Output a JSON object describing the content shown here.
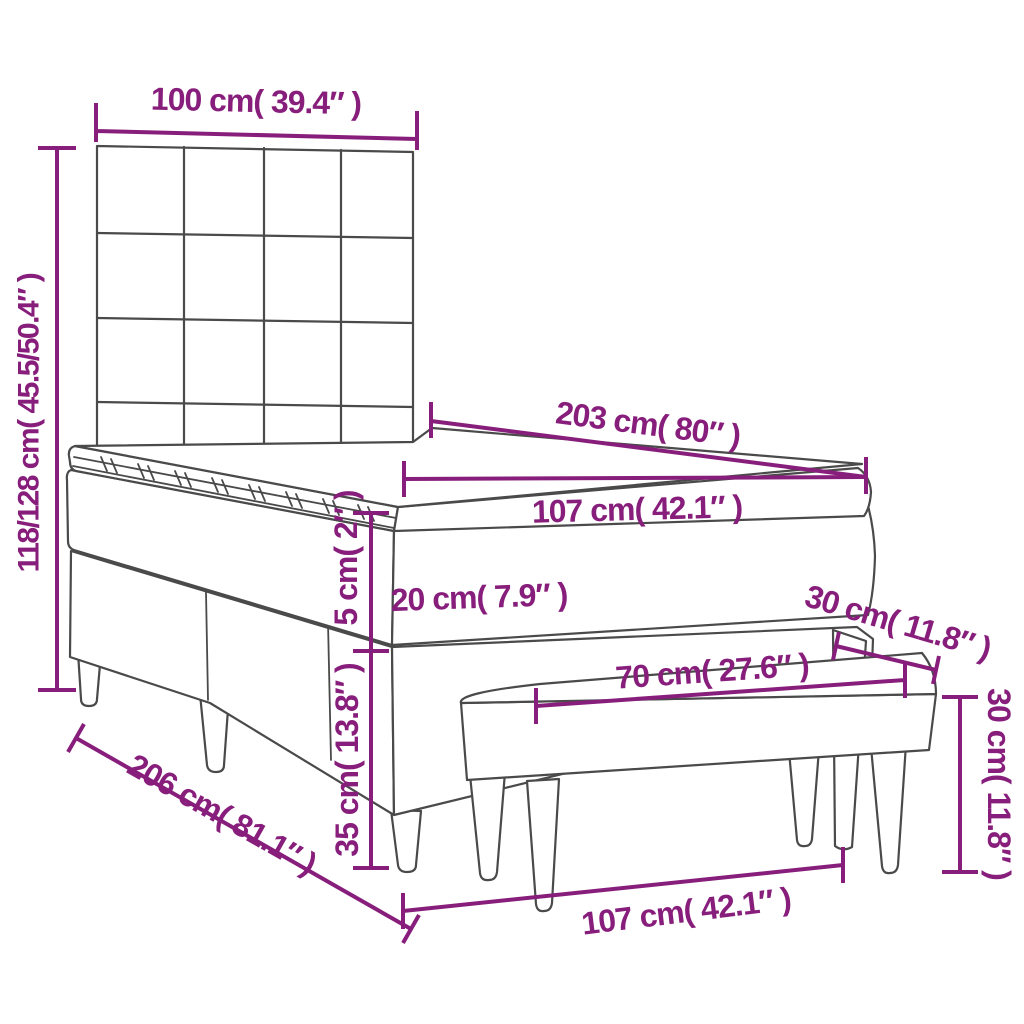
{
  "diagram": {
    "type": "furniture-dimension-diagram",
    "subject": "box spring bed with tufted headboard, mattress topper and bench",
    "colors": {
      "dimension_annotations": "#881E7B",
      "line_art": "#4A4A4A",
      "background": "#FFFFFF"
    },
    "dimensions": {
      "headboard_width": {
        "label": "100 cm( 39.4″ )"
      },
      "overall_height": {
        "label": "118/128 cm( 45.5/50.4″ )"
      },
      "bed_length": {
        "label": "203 cm( 80″ )"
      },
      "mattress_width": {
        "label": "107 cm( 42.1″ )"
      },
      "topper_height": {
        "label": "5 cm( 2″ )"
      },
      "mattress_height": {
        "label": "20 cm( 7.9″ )"
      },
      "base_height": {
        "label": "35 cm( 13.8″ )"
      },
      "bench_depth": {
        "label": "30 cm( 11.8″ )"
      },
      "bench_width": {
        "label": "70 cm( 27.6″ )"
      },
      "bench_height": {
        "label": "30 cm( 11.8″ )"
      },
      "base_length": {
        "label": "206 cm( 81.1″ )"
      },
      "bed_floor_width": {
        "label": "107 cm( 42.1″ )"
      }
    }
  }
}
